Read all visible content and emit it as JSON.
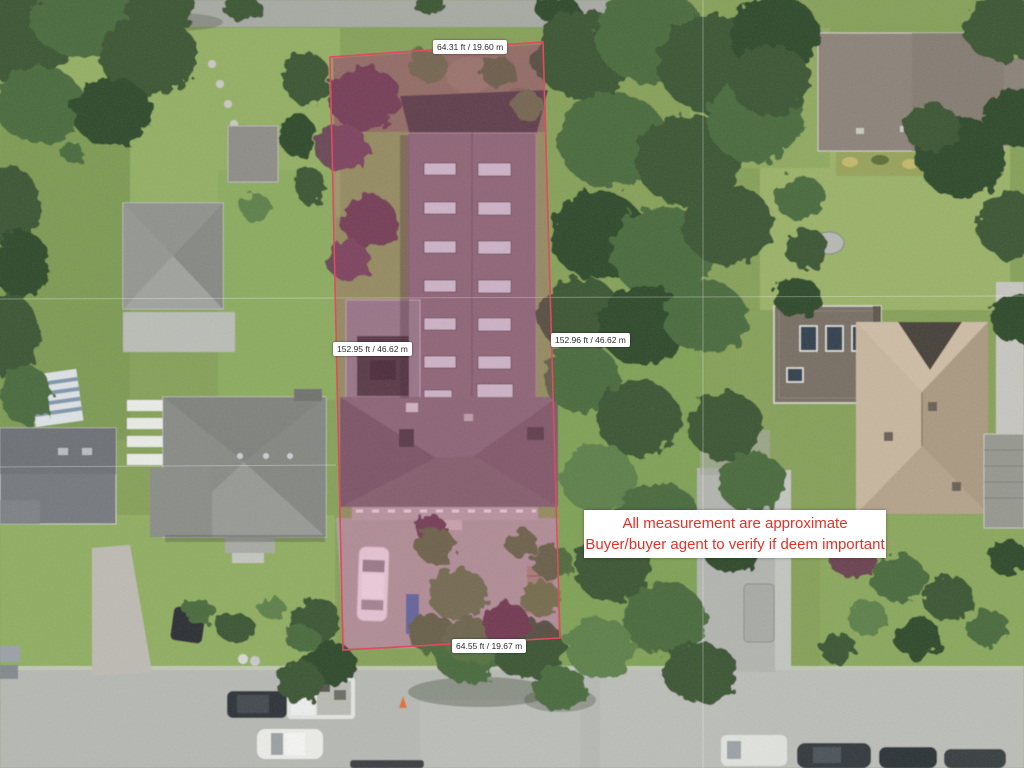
{
  "annotations": {
    "measurements": {
      "top": "64.31 ft / 19.60 m",
      "left": "152.95 ft / 46.62 m",
      "right": "152.96 ft / 46.62 m",
      "bottom": "64.55 ft / 19.67 m"
    },
    "disclaimer": {
      "line1": "All measurement are approximate",
      "line2": "Buyer/buyer agent to verify if deem important"
    }
  },
  "colors": {
    "lot_outline": "#e04a62",
    "lot_fill": "rgba(206,62,134,0.20)",
    "label_background": "#ffffff",
    "label_text": "#2b2b2b",
    "disclaimer_text": "#e53228",
    "disclaimer_background": "#ffffff"
  }
}
